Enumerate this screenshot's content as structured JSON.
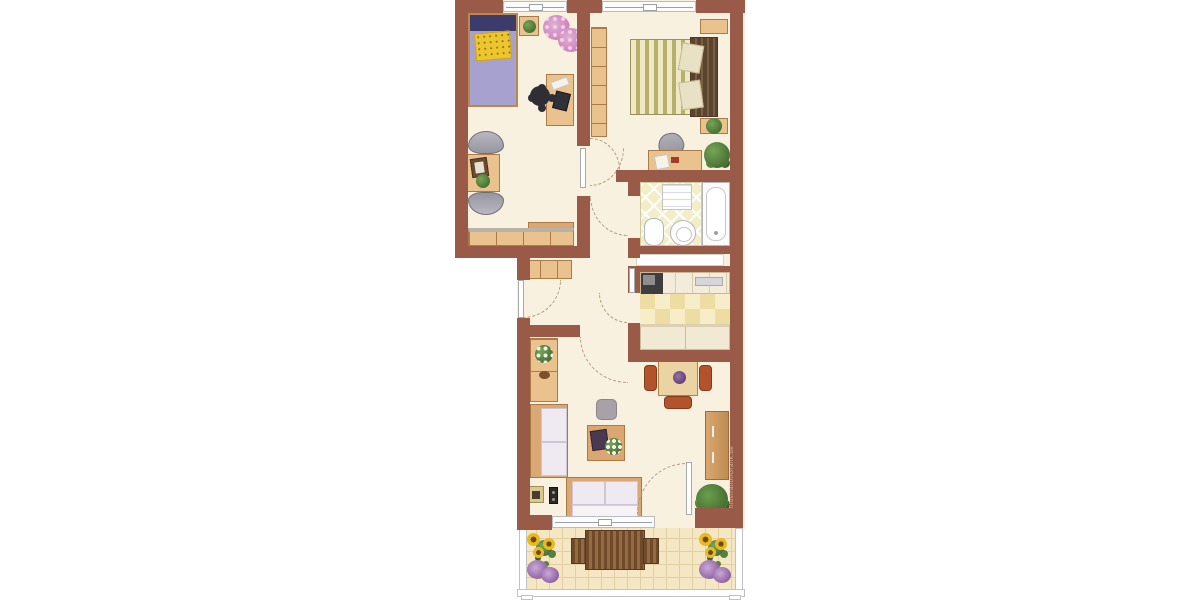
{
  "watermark": {
    "text": "IllustrationGrafik.de"
  },
  "palette": {
    "wall": "#9a5a48",
    "floor": "#f8f1df",
    "wood": "#eac28d",
    "woodBorder": "#aa7a48",
    "woodDark": "#d9a76f",
    "cushion": "#efe9f1",
    "gray": "#97959e",
    "navy": "#3b3c6b",
    "lavender": "#a7a1d0",
    "yellow": "#ecc52f",
    "stripeA": "#eee8c4",
    "stripeB": "#b7b06c",
    "headboard": "#5a442f",
    "pillow": "#e9e1c3",
    "chairOrange": "#b2532b",
    "plantDark": "#466f33",
    "pink": "#c97fb6",
    "sunflower": "#eab922",
    "purple": "#8d5f9e",
    "bathTile": "#f1eec9",
    "kitchenTileA": "#f7edc8",
    "kitchenTileB": "#eedda2",
    "balconyTile": "#f5e7c4",
    "balconyLine": "#e3cfa4",
    "benchDark": "#6f4a2b",
    "benchLight": "#946a41",
    "windowLine": "#9aa0a8",
    "arcColor": "#b29a7e",
    "watermarkColor": "#d9b49c"
  },
  "plan": {
    "type": "apartment-floor-plan",
    "rooms": [
      {
        "id": "children-room",
        "furniture": [
          "single-bed",
          "bedside-plant",
          "pink-plant",
          "desk",
          "desk-chair",
          "armchair",
          "side-table",
          "armchair",
          "sideboard"
        ]
      },
      {
        "id": "master-bedroom",
        "furniture": [
          "wardrobe",
          "double-bed",
          "wall-shelf",
          "plant-shelf",
          "desk",
          "office-chair",
          "floor-plant"
        ]
      },
      {
        "id": "bathroom",
        "furniture": [
          "towel-shelf",
          "bathtub",
          "toilet",
          "water-heater"
        ]
      },
      {
        "id": "kitchen",
        "furniture": [
          "stove",
          "counter-with-sink",
          "base-units"
        ]
      },
      {
        "id": "hallway",
        "furniture": [
          "wardrobe"
        ]
      },
      {
        "id": "living-room",
        "furniture": [
          "sideboard",
          "sofa",
          "sofa",
          "pouf",
          "coffee-table",
          "dining-table",
          "dining-chairs",
          "tv-board",
          "floor-plant",
          "picture-frame",
          "speaker"
        ]
      },
      {
        "id": "balcony",
        "furniture": [
          "flower-planter",
          "bench-set",
          "flower-planter"
        ]
      }
    ],
    "doors": [
      "entrance-door",
      "children-room-door",
      "master-bedroom-door",
      "bathroom-door",
      "kitchen-door",
      "living-room-door",
      "balcony-door"
    ],
    "windows": [
      "children-room-window",
      "master-bedroom-window",
      "balcony-window"
    ]
  }
}
